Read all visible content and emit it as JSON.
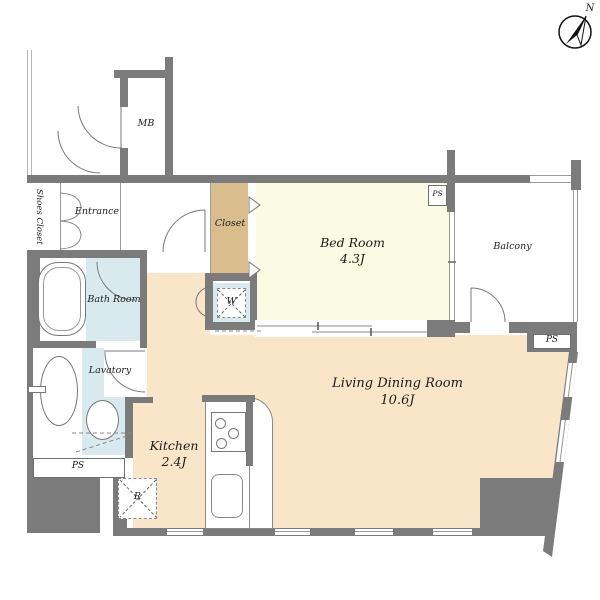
{
  "plan": {
    "title": "apartment-floor-plan",
    "compass": {
      "north_label": "N"
    },
    "rooms": {
      "entrance": {
        "label": "Entrance"
      },
      "shoes_closet": {
        "label": "Shoes Closet"
      },
      "mb": {
        "label": "MB"
      },
      "closet": {
        "label": "Closet"
      },
      "bedroom": {
        "label": "Bed Room",
        "size": "4.3J"
      },
      "balcony": {
        "label": "Balcony"
      },
      "bathroom": {
        "label": "Bath Room"
      },
      "lavatory": {
        "label": "Lavatory"
      },
      "kitchen": {
        "label": "Kitchen",
        "size": "2.4J"
      },
      "living": {
        "label": "Living Dining Room",
        "size": "10.6J"
      }
    },
    "fixtures": {
      "washer": "W",
      "refrigerator": "R"
    },
    "shafts": {
      "ps": "PS"
    },
    "colors": {
      "wall": "#7b7b7b",
      "floor_main": "#f9e6c8",
      "floor_bedroom": "#fbfae2",
      "floor_wet": "#d8eaed",
      "floor_closet": "#d9bd8c"
    }
  }
}
